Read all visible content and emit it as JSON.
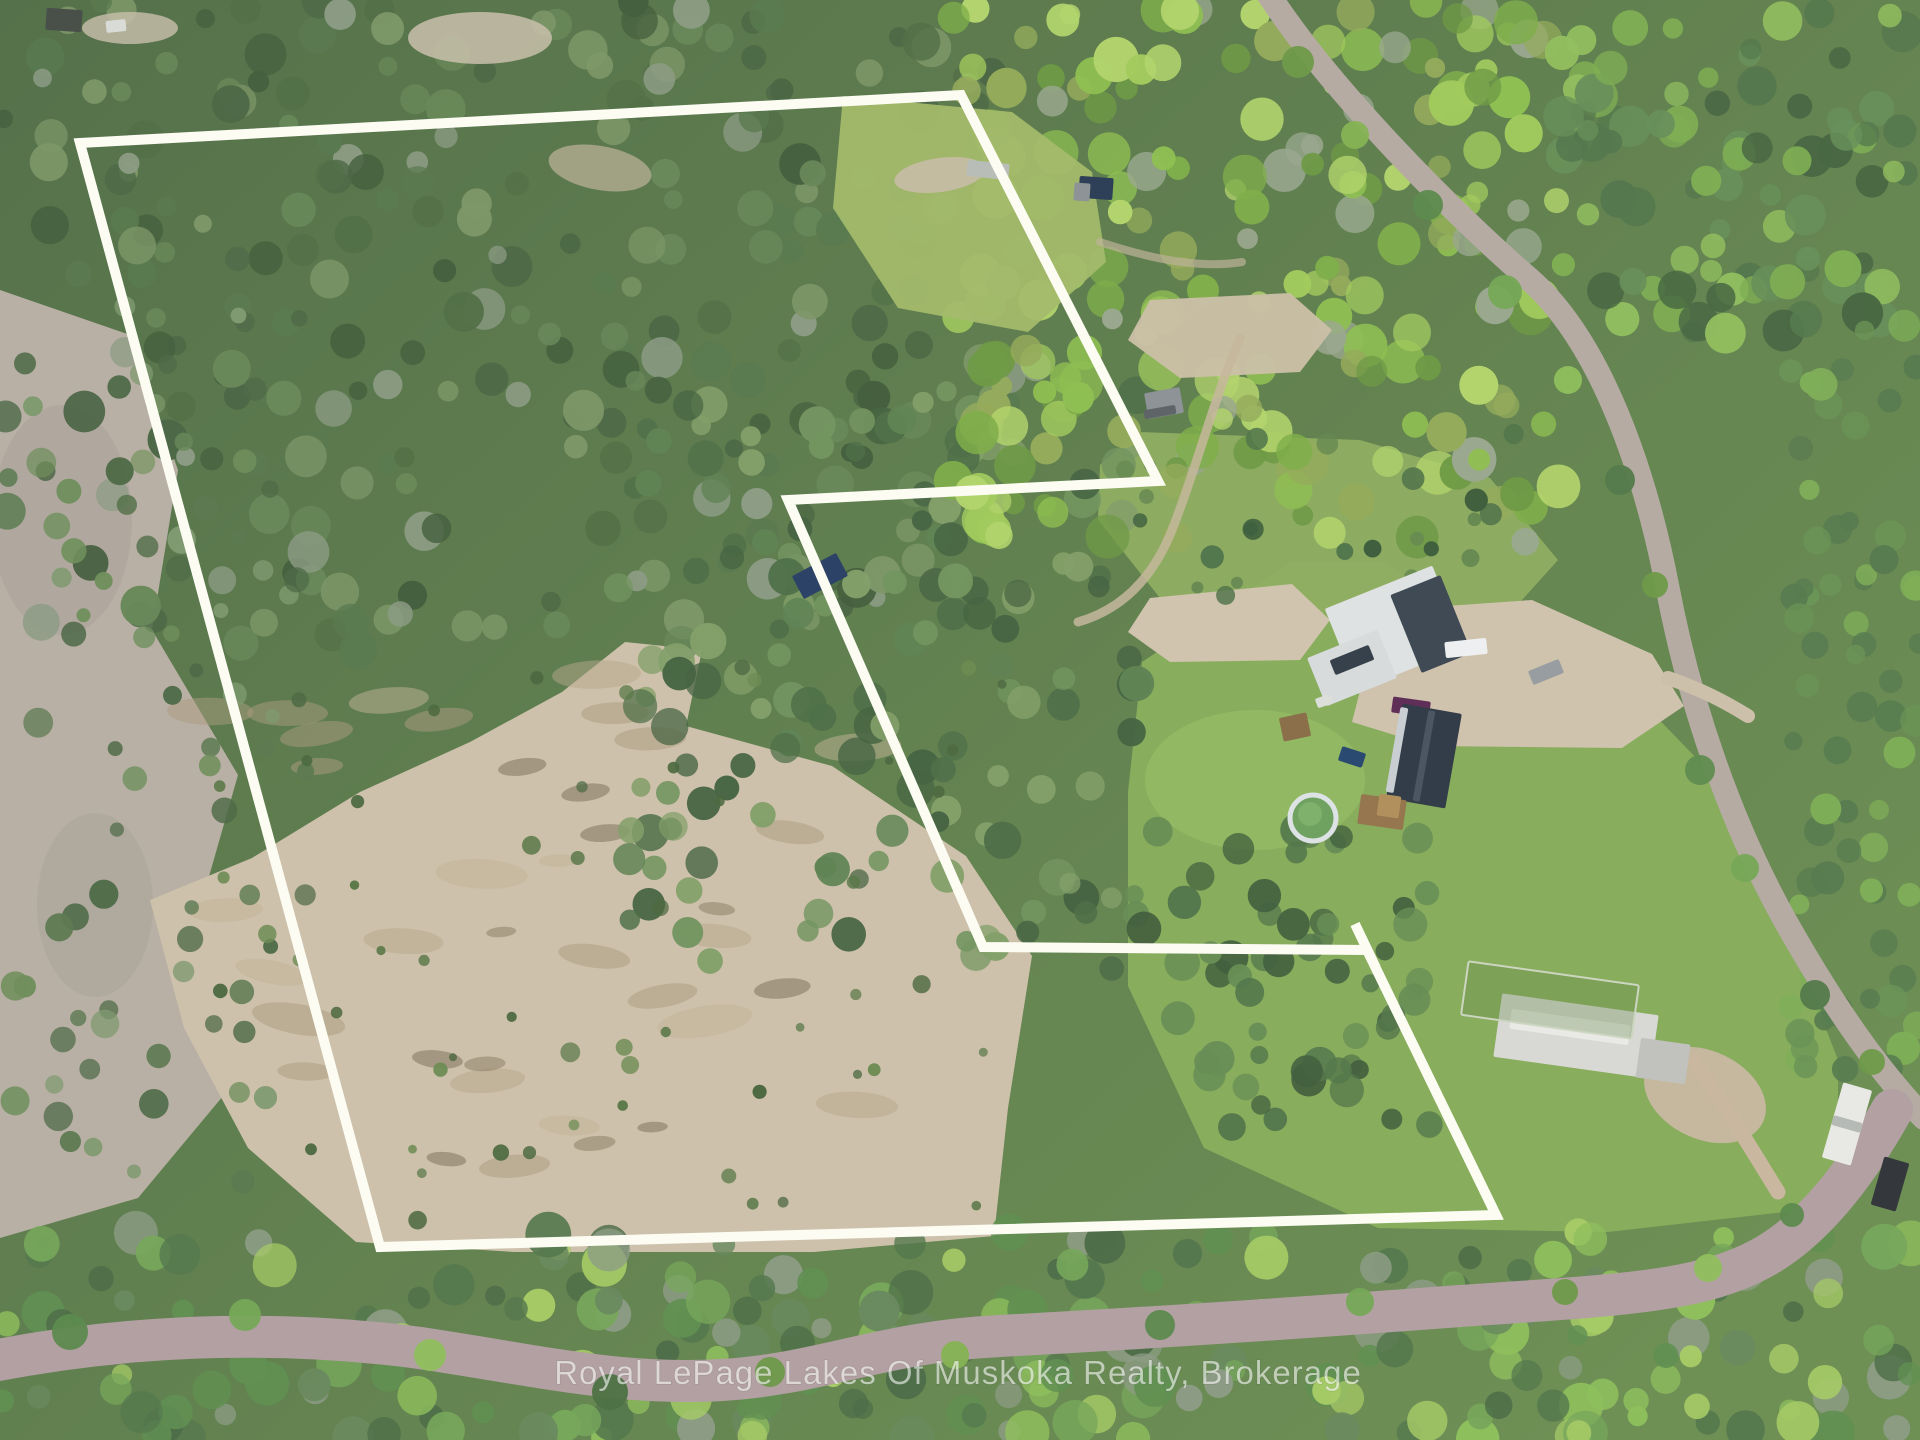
{
  "watermark": {
    "text": "Royal LePage Lakes Of Muskoka Realty, Brokerage"
  },
  "image": {
    "width": 1920,
    "height": 1440,
    "base_top": "#55714b",
    "base_bottom": "#6e9055"
  },
  "boundary": {
    "color": "#fcfcf3",
    "width": 10,
    "points": [
      [
        80,
        143
      ],
      [
        961,
        95
      ],
      [
        1158,
        481
      ],
      [
        788,
        500
      ],
      [
        983,
        947
      ],
      [
        1367,
        950
      ],
      [
        1496,
        1215
      ],
      [
        380,
        1247
      ]
    ],
    "overshoot": [
      [
        1355,
        924
      ],
      [
        1376,
        968
      ]
    ]
  },
  "terrain": [
    {
      "name": "rocky-slope-left",
      "shape": "polygon",
      "points": [
        [
          0,
          290
        ],
        [
          130,
          335
        ],
        [
          178,
          470
        ],
        [
          152,
          630
        ],
        [
          238,
          775
        ],
        [
          188,
          950
        ],
        [
          238,
          1078
        ],
        [
          138,
          1198
        ],
        [
          0,
          1238
        ]
      ],
      "fill": "#b8b0a4"
    },
    {
      "name": "rocky-streak-1",
      "shape": "ellipse",
      "cx": 62,
      "cy": 520,
      "rx": 70,
      "ry": 115,
      "fill": "#a6a096",
      "op": 0.45
    },
    {
      "name": "rocky-streak-2",
      "shape": "ellipse",
      "cx": 95,
      "cy": 905,
      "rx": 58,
      "ry": 92,
      "fill": "#a6a096",
      "op": 0.4
    },
    {
      "name": "big-sand-clearing",
      "shape": "polygon",
      "points": [
        [
          150,
          900
        ],
        [
          252,
          858
        ],
        [
          360,
          792
        ],
        [
          470,
          742
        ],
        [
          562,
          692
        ],
        [
          625,
          642
        ],
        [
          702,
          650
        ],
        [
          686,
          726
        ],
        [
          832,
          766
        ],
        [
          966,
          856
        ],
        [
          1032,
          956
        ],
        [
          1008,
          1108
        ],
        [
          994,
          1236
        ],
        [
          814,
          1252
        ],
        [
          514,
          1252
        ],
        [
          356,
          1242
        ],
        [
          248,
          1148
        ],
        [
          184,
          1028
        ]
      ],
      "fill": "#cdc1ab"
    },
    {
      "name": "lawn-main",
      "shape": "polygon",
      "points": [
        [
          1128,
          792
        ],
        [
          1142,
          662
        ],
        [
          1290,
          562
        ],
        [
          1382,
          562
        ],
        [
          1520,
          642
        ],
        [
          1642,
          702
        ],
        [
          1702,
          764
        ],
        [
          1776,
          900
        ],
        [
          1838,
          1060
        ],
        [
          1838,
          1206
        ],
        [
          1608,
          1232
        ],
        [
          1378,
          1228
        ],
        [
          1204,
          1148
        ],
        [
          1128,
          986
        ]
      ],
      "fill": "#88ad5d"
    },
    {
      "name": "meadow-north",
      "shape": "polygon",
      "points": [
        [
          1138,
          432
        ],
        [
          1360,
          440
        ],
        [
          1490,
          478
        ],
        [
          1558,
          560
        ],
        [
          1504,
          620
        ],
        [
          1300,
          612
        ],
        [
          1160,
          598
        ],
        [
          1098,
          520
        ],
        [
          1100,
          465
        ]
      ],
      "fill": "#8fae62",
      "op": 0.95
    },
    {
      "name": "lawn-bright-pool",
      "shape": "ellipse",
      "cx": 1255,
      "cy": 780,
      "rx": 110,
      "ry": 70,
      "fill": "#95bc66",
      "op": 0.75
    },
    {
      "name": "sand-patch-west",
      "shape": "polygon",
      "points": [
        [
          1128,
          632
        ],
        [
          1150,
          598
        ],
        [
          1292,
          584
        ],
        [
          1330,
          620
        ],
        [
          1300,
          660
        ],
        [
          1170,
          662
        ]
      ],
      "fill": "#d0c4ae"
    },
    {
      "name": "gravel-yard",
      "shape": "polygon",
      "points": [
        [
          1418,
          608
        ],
        [
          1532,
          600
        ],
        [
          1652,
          654
        ],
        [
          1684,
          706
        ],
        [
          1622,
          748
        ],
        [
          1430,
          746
        ],
        [
          1352,
          722
        ],
        [
          1368,
          660
        ]
      ],
      "fill": "#cfc3ad"
    },
    {
      "name": "dirt-front-house",
      "shape": "ellipse",
      "cx": 1705,
      "cy": 1095,
      "rx": 64,
      "ry": 44,
      "rot": 25,
      "fill": "#c8b8a1",
      "op": 0.95
    }
  ],
  "ground_patches": [
    {
      "name": "clearing-scrub",
      "x": 190,
      "y": 670,
      "w": 790,
      "h": 540,
      "count": 26,
      "rmin": 18,
      "rmax": 48,
      "squash": 0.32,
      "palette": [
        "#b6a78c",
        "#ab9c80",
        "#c2b398"
      ],
      "op": 0.5,
      "seed": 11
    },
    {
      "name": "clearing-soil",
      "x": 430,
      "y": 760,
      "w": 540,
      "h": 430,
      "count": 11,
      "rmin": 14,
      "rmax": 32,
      "squash": 0.35,
      "palette": [
        "#8a7b62",
        "#7a6d58"
      ],
      "op": 0.5,
      "seed": 12
    }
  ],
  "forest_regions": [
    {
      "name": "forest-top-left",
      "x": 0,
      "y": 0,
      "w": 1010,
      "h": 650,
      "count": 255,
      "rmin": 9,
      "rmax": 21,
      "palette": [
        "#4c6846",
        "#5a7a50",
        "#69895a",
        "#537048",
        "#7d9768",
        "#8d9c85",
        "#45603f"
      ],
      "seed": 1
    },
    {
      "name": "forest-left-sparse",
      "x": 0,
      "y": 255,
      "w": 310,
      "h": 995,
      "count": 80,
      "rmin": 7,
      "rmax": 15,
      "palette": [
        "#5d7a52",
        "#6f8f5c",
        "#4f6b48",
        "#7f9a70"
      ],
      "seed": 5
    },
    {
      "name": "forest-mid-band",
      "x": 615,
      "y": 380,
      "w": 525,
      "h": 590,
      "count": 150,
      "rmin": 9,
      "rmax": 19,
      "palette": [
        "#4f7049",
        "#618455",
        "#739560",
        "#476543",
        "#84a06a"
      ],
      "seed": 4
    },
    {
      "name": "forest-top-right-deciduous",
      "x": 950,
      "y": 0,
      "w": 610,
      "h": 545,
      "count": 205,
      "rmin": 10,
      "rmax": 23,
      "palette": [
        "#8fbf52",
        "#a2cb5e",
        "#7fae4b",
        "#b3d46d",
        "#6f9a46",
        "#95ab5c",
        "#9aa88f"
      ],
      "seed": 2
    },
    {
      "name": "forest-right-corner",
      "x": 1560,
      "y": 0,
      "w": 360,
      "h": 335,
      "count": 90,
      "rmin": 10,
      "rmax": 21,
      "palette": [
        "#55784e",
        "#68905a",
        "#7fae54",
        "#92bf5f",
        "#486743"
      ],
      "seed": 3
    },
    {
      "name": "forest-right-edge",
      "x": 1790,
      "y": 300,
      "w": 130,
      "h": 780,
      "count": 70,
      "rmin": 9,
      "rmax": 17,
      "palette": [
        "#587c50",
        "#6b9457",
        "#7fae58"
      ],
      "seed": 13
    },
    {
      "name": "forest-cluster-se-pool",
      "x": 1130,
      "y": 830,
      "w": 300,
      "h": 300,
      "count": 60,
      "rmin": 9,
      "rmax": 18,
      "palette": [
        "#43603f",
        "#55784c",
        "#688e56"
      ],
      "seed": 14
    },
    {
      "name": "forest-bottom-band",
      "x": 0,
      "y": 1232,
      "w": 1920,
      "h": 208,
      "count": 235,
      "rmin": 10,
      "rmax": 23,
      "palette": [
        "#4e6e49",
        "#619052",
        "#77a75b",
        "#8fbf5d",
        "#a6cb66",
        "#55784e",
        "#6a8a5f",
        "#8d9c85"
      ],
      "seed": 6
    },
    {
      "name": "clearing-bushes",
      "x": 210,
      "y": 650,
      "w": 810,
      "h": 580,
      "count": 55,
      "rmin": 4,
      "rmax": 10,
      "palette": [
        "#5c7a4a",
        "#6d8c54",
        "#4e6a42"
      ],
      "seed": 8
    },
    {
      "name": "meadow-bushes",
      "x": 1110,
      "y": 430,
      "w": 440,
      "h": 185,
      "count": 26,
      "rmin": 5,
      "rmax": 12,
      "palette": [
        "#53764c",
        "#3f5f3e",
        "#668852"
      ],
      "seed": 9
    }
  ],
  "overlays": [
    {
      "name": "grass-clearing-top-right",
      "shape": "polygon",
      "points": [
        [
          843,
          96
        ],
        [
          1012,
          112
        ],
        [
          1092,
          172
        ],
        [
          1106,
          262
        ],
        [
          1028,
          332
        ],
        [
          898,
          308
        ],
        [
          833,
          208
        ]
      ],
      "fill": "#a3bb6c",
      "op": 0.95
    },
    {
      "name": "dirt-top-right",
      "shape": "ellipse",
      "cx": 940,
      "cy": 175,
      "rx": 46,
      "ry": 17,
      "rot": -8,
      "fill": "#c6bca6",
      "op": 0.9
    },
    {
      "name": "dirt-north-shed",
      "shape": "polygon",
      "points": [
        [
          1150,
          300
        ],
        [
          1290,
          293
        ],
        [
          1332,
          330
        ],
        [
          1300,
          372
        ],
        [
          1180,
          378
        ],
        [
          1128,
          340
        ]
      ],
      "fill": "#cbc0a8",
      "op": 0.95
    },
    {
      "name": "clearing-top-center",
      "shape": "ellipse",
      "cx": 480,
      "cy": 38,
      "rx": 72,
      "ry": 26,
      "fill": "#c9bfac",
      "op": 0.85
    },
    {
      "name": "clearing-top-center-2",
      "shape": "ellipse",
      "cx": 600,
      "cy": 168,
      "rx": 52,
      "ry": 22,
      "rot": 10,
      "fill": "#bfb29a",
      "op": 0.7
    },
    {
      "name": "clearing-top-left",
      "shape": "ellipse",
      "cx": 130,
      "cy": 28,
      "rx": 48,
      "ry": 16,
      "fill": "#c9bfac",
      "op": 0.8
    }
  ],
  "roads": [
    {
      "name": "road-right",
      "d": "M1267,-8 C1330,90 1455,215 1528,278 C1600,340 1645,470 1668,590 C1690,705 1730,820 1782,915 C1835,1010 1880,1072 1924,1118",
      "stroke": "#b5aba3",
      "w": 24
    },
    {
      "name": "road-bottom",
      "d": "M-12,1362 C150,1330 300,1332 420,1348 C540,1366 622,1386 722,1380 C822,1374 880,1342 1000,1336 C1150,1328 1300,1318 1460,1306 C1620,1295 1700,1292 1762,1258 C1820,1226 1864,1160 1892,1110",
      "stroke": "#b2a0a2",
      "w": 42
    },
    {
      "name": "driveway-white-house",
      "d": "M1695,1062 C1725,1105 1752,1150 1778,1192",
      "stroke": "#c9b79f",
      "w": 15
    },
    {
      "name": "driveway-barn",
      "d": "M1668,678 C1702,690 1722,700 1748,716",
      "stroke": "#cdc0aa",
      "w": 14
    },
    {
      "name": "track-to-shed",
      "d": "M1240,338 C1215,395 1196,470 1172,530 C1152,580 1120,610 1078,622",
      "stroke": "#c6b79c",
      "w": 9,
      "op": 0.85
    },
    {
      "name": "path-top-right",
      "d": "M1100,242 C1160,262 1205,268 1242,262",
      "stroke": "#bdb298",
      "w": 8,
      "op": 0.7
    }
  ],
  "overhang_trees": [
    [
      1298,
      62,
      16,
      "#6f9a4a"
    ],
    [
      1355,
      135,
      14,
      "#86b354"
    ],
    [
      1428,
      205,
      15,
      "#5d8a4e"
    ],
    [
      1505,
      292,
      17,
      "#76a857"
    ],
    [
      1568,
      380,
      14,
      "#8fbf5d"
    ],
    [
      1620,
      480,
      15,
      "#557a4c"
    ],
    [
      1655,
      585,
      13,
      "#6f9a4a"
    ],
    [
      1700,
      770,
      15,
      "#618c50"
    ],
    [
      1745,
      868,
      14,
      "#76a857"
    ],
    [
      1815,
      995,
      15,
      "#557a4c"
    ],
    [
      1872,
      1062,
      13,
      "#6f9a4a"
    ],
    [
      70,
      1332,
      18,
      "#5d8a4e"
    ],
    [
      245,
      1315,
      16,
      "#76a857"
    ],
    [
      430,
      1355,
      16,
      "#8fbf5d"
    ],
    [
      610,
      1392,
      18,
      "#4e7245"
    ],
    [
      770,
      1372,
      15,
      "#6f9a4a"
    ],
    [
      955,
      1355,
      14,
      "#86b354"
    ],
    [
      1160,
      1325,
      15,
      "#5d8a4e"
    ],
    [
      1360,
      1302,
      14,
      "#76a857"
    ],
    [
      1565,
      1292,
      13,
      "#6f9a4a"
    ],
    [
      1708,
      1268,
      14,
      "#8fbf5d"
    ],
    [
      1792,
      1215,
      12,
      "#5d8a4e"
    ]
  ],
  "objects": [
    {
      "name": "barn-roof-main",
      "shape": "rect",
      "cx": 1395,
      "cy": 628,
      "w": 116,
      "h": 88,
      "rot": -22,
      "fill": "#dfe2e3"
    },
    {
      "name": "barn-roof-dark",
      "shape": "rect",
      "cx": 1431,
      "cy": 624,
      "w": 54,
      "h": 84,
      "rot": -22,
      "fill": "#3f4a55"
    },
    {
      "name": "barn-wing",
      "shape": "rect",
      "cx": 1352,
      "cy": 668,
      "w": 76,
      "h": 52,
      "rot": -22,
      "fill": "#d8dbdc"
    },
    {
      "name": "barn-wing-dark",
      "shape": "rect",
      "cx": 1352,
      "cy": 660,
      "w": 42,
      "h": 16,
      "rot": -22,
      "fill": "#37414b"
    },
    {
      "name": "white-pickup",
      "shape": "rect",
      "cx": 1466,
      "cy": 648,
      "w": 42,
      "h": 16,
      "rot": -6,
      "fill": "#edeff0"
    },
    {
      "name": "gray-car",
      "shape": "rect",
      "cx": 1546,
      "cy": 672,
      "w": 33,
      "h": 15,
      "rot": -22,
      "fill": "#979da1"
    },
    {
      "name": "purple-car",
      "shape": "rect",
      "cx": 1411,
      "cy": 707,
      "w": 38,
      "h": 16,
      "rot": 8,
      "fill": "#5f2f57"
    },
    {
      "name": "dark-roof-house",
      "shape": "rect",
      "cx": 1424,
      "cy": 756,
      "w": 60,
      "h": 96,
      "rot": 10,
      "fill": "#333d49"
    },
    {
      "name": "dark-roof-ridge",
      "shape": "rect",
      "cx": 1424,
      "cy": 756,
      "w": 7,
      "h": 92,
      "rot": 10,
      "fill": "#4c5663"
    },
    {
      "name": "dark-roof-eave",
      "shape": "rect",
      "cx": 1397,
      "cy": 750,
      "w": 8,
      "h": 86,
      "rot": 10,
      "fill": "#c9ced2"
    },
    {
      "name": "deck",
      "shape": "rect",
      "cx": 1382,
      "cy": 812,
      "w": 46,
      "h": 30,
      "rot": 8,
      "fill": "#96764f"
    },
    {
      "name": "deck-light",
      "shape": "rect",
      "cx": 1389,
      "cy": 806,
      "w": 22,
      "h": 22,
      "rot": 8,
      "fill": "#b2905e"
    },
    {
      "name": "pool",
      "shape": "circle",
      "cx": 1313,
      "cy": 818,
      "r": 23,
      "fill": "#6fa161",
      "stroke": "#dde2e5",
      "sw": 5
    },
    {
      "name": "pool-highlight",
      "shape": "circle",
      "cx": 1310,
      "cy": 814,
      "r": 12,
      "fill": "#7fb06c"
    },
    {
      "name": "wood-pallets",
      "shape": "rect",
      "cx": 1295,
      "cy": 727,
      "w": 28,
      "h": 24,
      "rot": -12,
      "fill": "#8a6f4a"
    },
    {
      "name": "white-planks",
      "shape": "rect",
      "cx": 1324,
      "cy": 701,
      "w": 16,
      "h": 10,
      "rot": -20,
      "fill": "#dcdfd9"
    },
    {
      "name": "blue-boat",
      "shape": "rect",
      "cx": 1352,
      "cy": 757,
      "w": 25,
      "h": 15,
      "rot": 18,
      "fill": "#2a4a72"
    },
    {
      "name": "white-house-roof",
      "shape": "rect",
      "cx": 1576,
      "cy": 1036,
      "w": 158,
      "h": 64,
      "rot": 8,
      "fill": "#d8d9d4"
    },
    {
      "name": "white-house-hip",
      "shape": "rect",
      "cx": 1570,
      "cy": 1027,
      "w": 120,
      "h": 20,
      "rot": 8,
      "fill": "#e9eae6"
    },
    {
      "name": "white-house-wing",
      "shape": "rect",
      "cx": 1663,
      "cy": 1061,
      "w": 50,
      "h": 40,
      "rot": 8,
      "fill": "#c1c2be"
    },
    {
      "name": "garden-fence",
      "shape": "rect",
      "cx": 1550,
      "cy": 1000,
      "w": 172,
      "h": 54,
      "rot": 8,
      "fill": "#6e8c50",
      "op": 0.35,
      "stroke": "#ccd5bf",
      "sw": 2
    },
    {
      "name": "rv-trailer",
      "shape": "rect",
      "cx": 1847,
      "cy": 1124,
      "w": 30,
      "h": 78,
      "rot": 16,
      "fill": "#e8e9e4"
    },
    {
      "name": "rv-stripe",
      "shape": "rect",
      "cx": 1847,
      "cy": 1124,
      "w": 30,
      "h": 10,
      "rot": 16,
      "fill": "#b6bab6"
    },
    {
      "name": "dark-suv",
      "shape": "rect",
      "cx": 1890,
      "cy": 1184,
      "w": 26,
      "h": 50,
      "rot": 16,
      "fill": "#34383d"
    },
    {
      "name": "gray-shed-mid",
      "shape": "rect",
      "cx": 1164,
      "cy": 403,
      "w": 36,
      "h": 26,
      "rot": -10,
      "fill": "#8e9397"
    },
    {
      "name": "gray-shed-side",
      "shape": "rect",
      "cx": 1160,
      "cy": 412,
      "w": 32,
      "h": 9,
      "rot": -10,
      "fill": "#5f6468"
    },
    {
      "name": "cabin-top",
      "shape": "rect",
      "cx": 1096,
      "cy": 188,
      "w": 34,
      "h": 22,
      "rot": 4,
      "fill": "#2e4057"
    },
    {
      "name": "cabin-top-gray",
      "shape": "rect",
      "cx": 1082,
      "cy": 192,
      "w": 16,
      "h": 18,
      "rot": 4,
      "fill": "#8e9397"
    },
    {
      "name": "gray-trailer-top",
      "shape": "rect",
      "cx": 988,
      "cy": 170,
      "w": 42,
      "h": 16,
      "rot": 6,
      "fill": "#b9bdb8"
    },
    {
      "name": "navy-trailer-woods",
      "shape": "rect",
      "cx": 820,
      "cy": 576,
      "w": 50,
      "h": 26,
      "rot": -28,
      "fill": "#2c4266"
    },
    {
      "name": "shed-top-left",
      "shape": "rect",
      "cx": 64,
      "cy": 20,
      "w": 36,
      "h": 22,
      "rot": 4,
      "fill": "#49504a"
    },
    {
      "name": "white-object-top-left",
      "shape": "rect",
      "cx": 116,
      "cy": 26,
      "w": 20,
      "h": 12,
      "rot": -6,
      "fill": "#d8dbd6"
    }
  ]
}
